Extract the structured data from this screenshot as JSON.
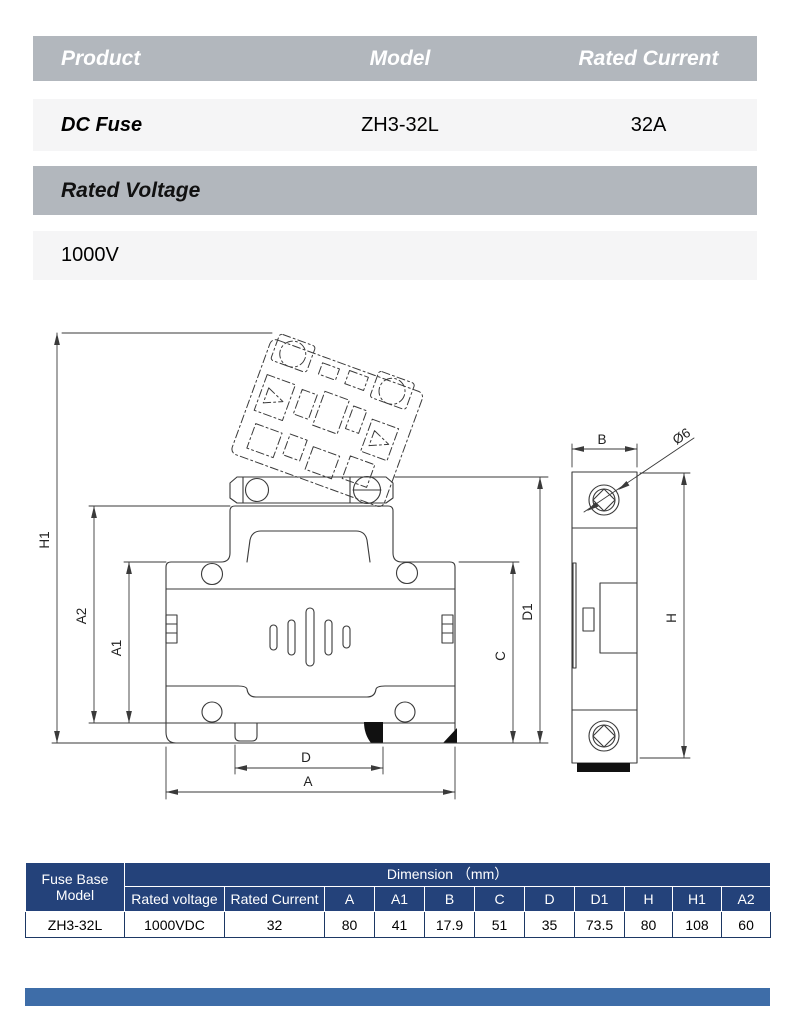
{
  "spec_table": {
    "headers": [
      "Product",
      "Model",
      "Rated Current"
    ],
    "product": "DC Fuse",
    "model": "ZH3-32L",
    "rated_current": "32A"
  },
  "voltage": {
    "label": "Rated Voltage",
    "value": "1000V"
  },
  "drawing": {
    "labels": {
      "h1": "H1",
      "a2": "A2",
      "a1": "A1",
      "d": "D",
      "a": "A",
      "c": "C",
      "d1": "D1",
      "b": "B",
      "dia": "Ø6",
      "h": "H"
    }
  },
  "dim_table": {
    "corner_header": "Fuse Base Model",
    "dimension_header": "Dimension （mm）",
    "columns": [
      "Rated voltage",
      "Rated Current",
      "A",
      "A1",
      "B",
      "C",
      "D",
      "D1",
      "H",
      "H1",
      "A2"
    ],
    "row": {
      "model": "ZH3-32L",
      "rated_voltage": "1000VDC",
      "rated_current": "32",
      "a": "80",
      "a1": "41",
      "b": "17.9",
      "c": "51",
      "d": "35",
      "d1": "73.5",
      "h": "80",
      "h1": "108",
      "a2": "60"
    }
  },
  "colors": {
    "header_gray": "#b2b7bd",
    "row_light": "#f5f5f6",
    "table_header_blue": "#24427a",
    "footer_bar_blue": "#3e6da8",
    "drawing_line": "#3a3a3a"
  }
}
